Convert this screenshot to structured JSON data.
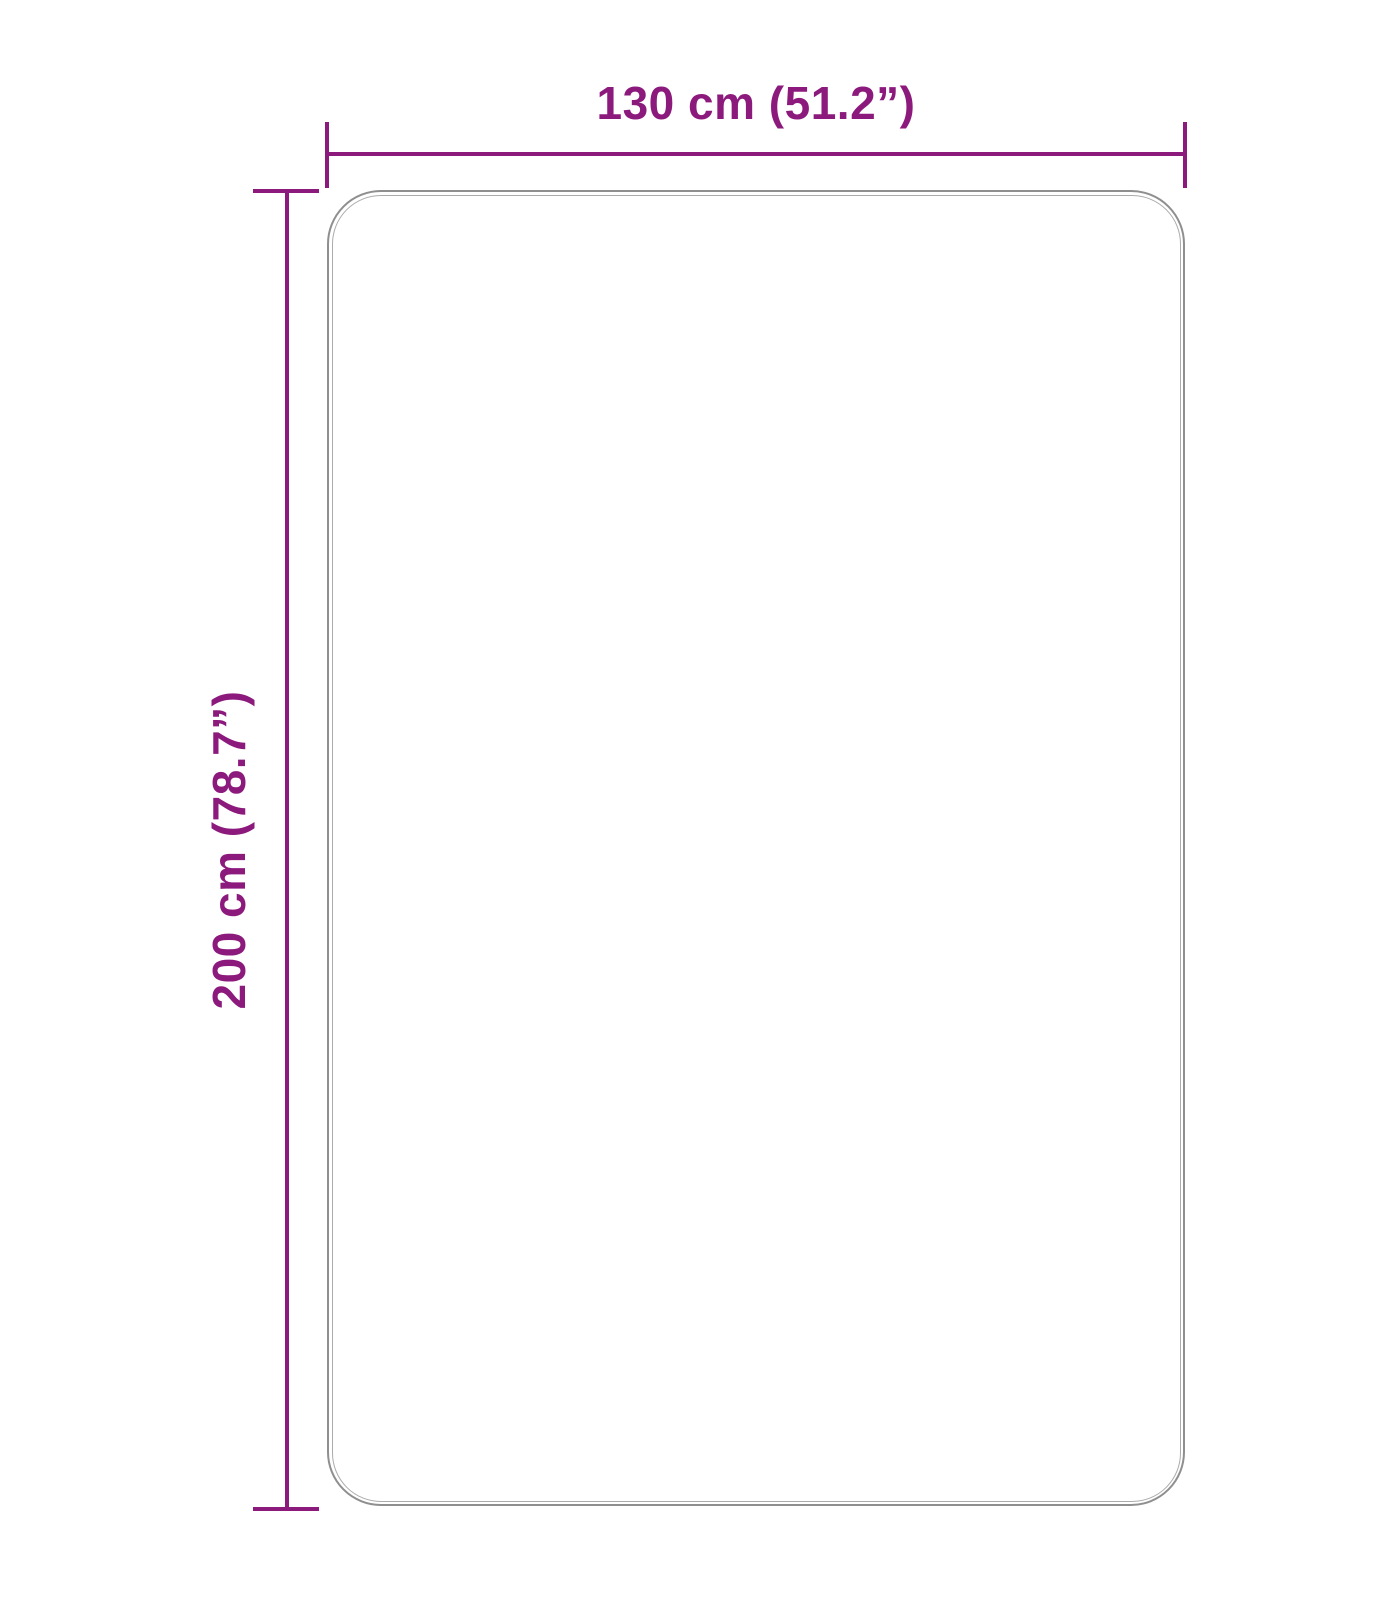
{
  "diagram": {
    "type": "product-dimension-drawing",
    "shape": "rounded-rectangle",
    "width_label": "130 cm (51.2”)",
    "height_label": "200 cm (78.7”)",
    "width_cm": 130,
    "width_inches": 51.2,
    "height_cm": 200,
    "height_inches": 78.7
  },
  "colors": {
    "dimension_accent": "#8c1a7d",
    "outline_outer": "#8f8f8f",
    "outline_inner": "#ababab",
    "background": "#ffffff"
  }
}
